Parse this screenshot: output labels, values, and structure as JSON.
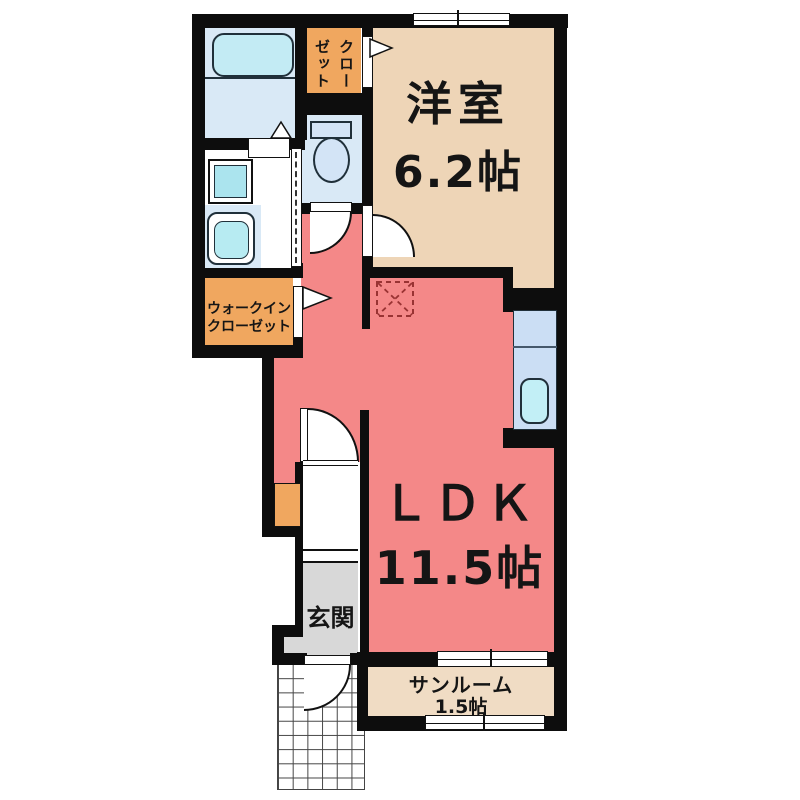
{
  "floorplan": {
    "rooms": {
      "western_room": {
        "label": "洋室",
        "size": "6.2帖"
      },
      "ldk": {
        "label": "ＬＤＫ",
        "size": "11.5帖"
      },
      "sunroom": {
        "label": "サンルーム",
        "size": "1.5帖"
      },
      "entrance": {
        "label": "玄関"
      },
      "walk_in_closet": {
        "label": "ウォークイン\nクローゼット"
      },
      "closet": {
        "label": "クロー\nゼット"
      }
    },
    "fixtures": [
      "bathtub",
      "washing-machine-pan",
      "vanity-basin",
      "toilet",
      "kitchen-counter-sink",
      "refrigerator-space",
      "entrance-step",
      "porch-tiles"
    ],
    "colors": {
      "ldk": "#f48888",
      "western_room": "#eed5b7",
      "sunroom": "#f0dcc4",
      "closet_orange": "#f0a75f",
      "wet_area_blue": "#d9e9f6",
      "bathtub_cyan": "#c3ebf4",
      "kitchen_blue": "#cbdef4",
      "entrance_gray": "#d8d8d8",
      "wall_black": "#0d0d0d",
      "fridge_dash_red": "#993333"
    }
  }
}
